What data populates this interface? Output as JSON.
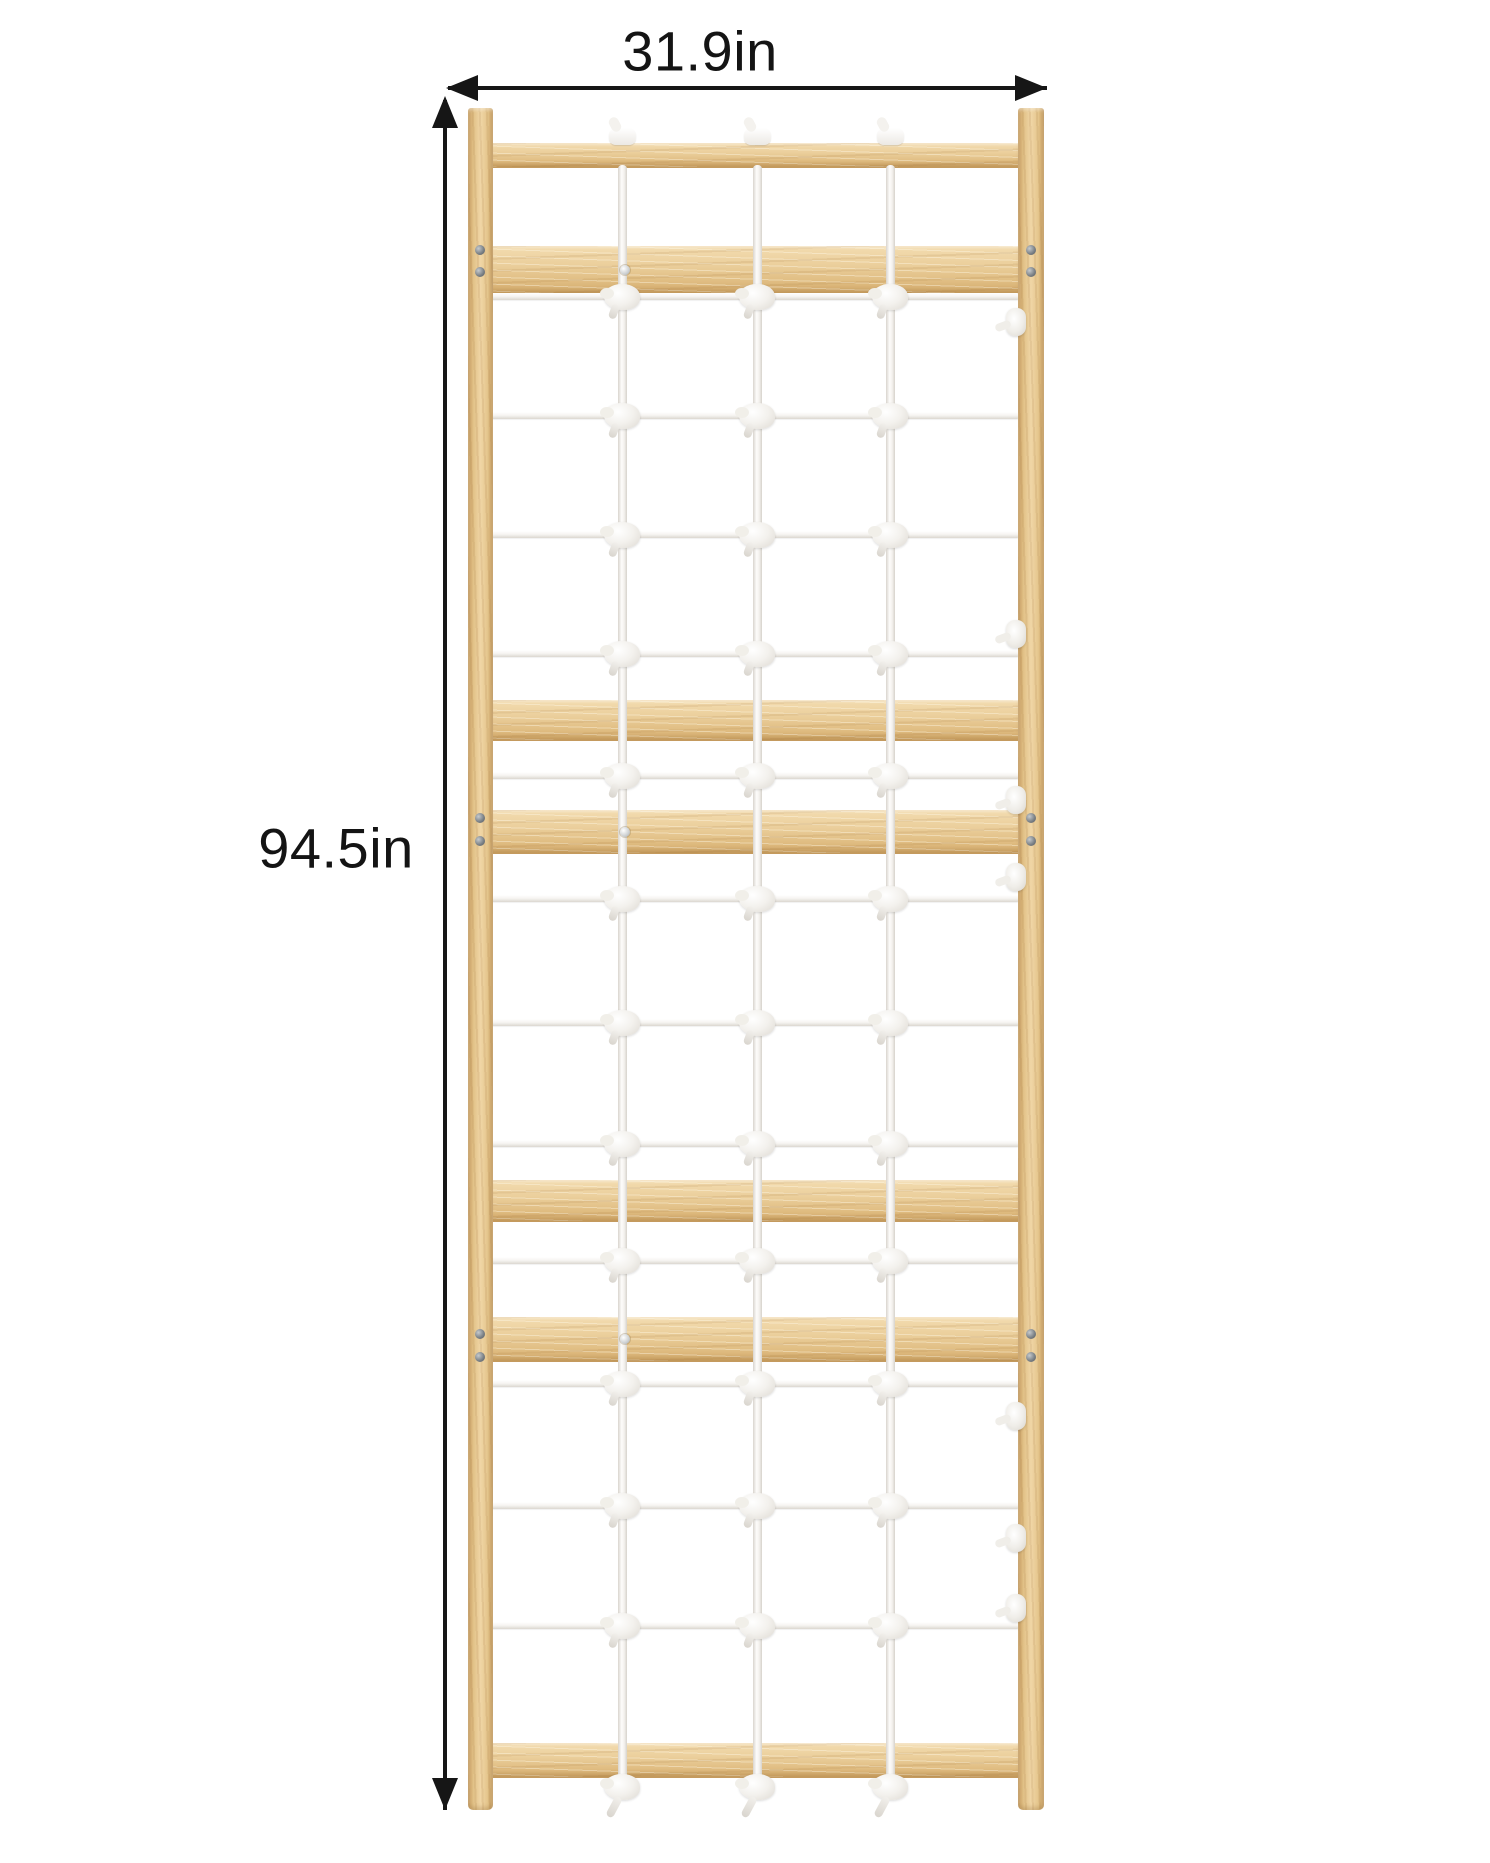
{
  "diagram": {
    "type": "product-dimension-diagram",
    "subject": "wooden swedish-ladder climbing frame with white rope net",
    "background": "#ffffff"
  },
  "dimensions": {
    "width": {
      "label": "31.9in",
      "value": 31.9,
      "unit": "in"
    },
    "height": {
      "label": "94.5in",
      "value": 94.5,
      "unit": "in"
    }
  },
  "colors": {
    "wood_light": "#f0d6a6",
    "wood_mid": "#e0bd82",
    "wood_dark": "#c49a5c",
    "rope": "#f6f4f1",
    "rope_shadow": "#d9d5ce",
    "arrow": "#161616",
    "text": "#141414",
    "screw_dark": "#777d82",
    "screw_light": "#cdd0d2"
  },
  "icons": {
    "arrowhead_left": "arrowhead-left-icon",
    "arrowhead_right": "arrowhead-right-icon",
    "arrowhead_up": "arrowhead-up-icon",
    "arrowhead_down": "arrowhead-down-icon"
  },
  "figure": {
    "canvas": {
      "width": 1490,
      "height": 1863
    },
    "posts": {
      "left": {
        "x": 468,
        "y": 108,
        "w": 25,
        "h": 1702
      },
      "right": {
        "x": 1018,
        "y": 108,
        "w": 26,
        "h": 1702
      }
    },
    "slat_x": 490,
    "slat_w": 530,
    "slats": [
      {
        "name": "top-rail",
        "y": 143,
        "h": 24
      },
      {
        "name": "slat-1",
        "y": 246,
        "h": 47
      },
      {
        "name": "slat-2",
        "y": 700,
        "h": 40
      },
      {
        "name": "slat-3",
        "y": 810,
        "h": 43
      },
      {
        "name": "slat-4",
        "y": 1180,
        "h": 41
      },
      {
        "name": "slat-5",
        "y": 1317,
        "h": 44
      },
      {
        "name": "bottom-rail",
        "y": 1743,
        "h": 34
      }
    ],
    "net": {
      "horizontal_rope_y": [
        296,
        415,
        534,
        653,
        775,
        898,
        1022,
        1143,
        1260,
        1383,
        1505,
        1625
      ],
      "vertical_rope_x": [
        622,
        757,
        890
      ],
      "rope_top_y": 165,
      "rope_bottom_y": 1780,
      "cap_y": 128,
      "bottom_knot_y": 1786
    },
    "cleats": {
      "x": 1016,
      "y": [
        322,
        634,
        800,
        877,
        1416,
        1538,
        1608
      ]
    },
    "screws": {
      "pairs": [
        {
          "x": 480,
          "ys": [
            250,
            272
          ]
        },
        {
          "x": 480,
          "ys": [
            818,
            841
          ]
        },
        {
          "x": 480,
          "ys": [
            1334,
            1357
          ]
        },
        {
          "x": 1031,
          "ys": [
            250,
            272
          ]
        },
        {
          "x": 1031,
          "ys": [
            818,
            841
          ]
        },
        {
          "x": 1031,
          "ys": [
            1334,
            1357
          ]
        }
      ],
      "mid": [
        {
          "x": 625,
          "y": 270
        },
        {
          "x": 625,
          "y": 832
        },
        {
          "x": 625,
          "y": 1339
        }
      ]
    }
  }
}
